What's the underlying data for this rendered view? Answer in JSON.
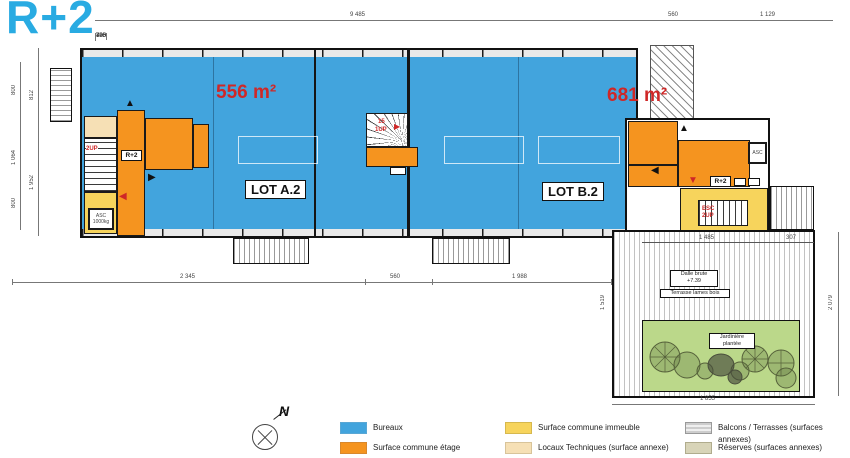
{
  "title": "R+2",
  "colors": {
    "title": "#29abe2",
    "bureaux": "#42a4dd",
    "commune-etage": "#f5941f",
    "commune-immeuble": "#f7d45c",
    "locaux": "#f6e0b5",
    "reserves": "#d8d4b8",
    "garden": "#bbd88a",
    "red": "#cf2727"
  },
  "areas": {
    "lot_a_area": "556 m²",
    "lot_b_area": "681 m²",
    "lot_a": "LOT A.2",
    "lot_b": "LOT B.2"
  },
  "cores": {
    "left_label": "R+2",
    "right_label": "R+2",
    "stair_left": "2UP",
    "stair_mid_count": "15",
    "stair_mid": "1UP",
    "stair_right_1": "ESC",
    "stair_right_2": "2UP",
    "elev_left_1": "ASC",
    "elev_left_2": "1000kg",
    "elev_right": "ASC"
  },
  "terrace": {
    "dalle_1": "Dalle brute",
    "dalle_2": "+7.39",
    "lames": "Terrasse lames bois",
    "jard_1": "Jardinière",
    "jard_2": "plantée"
  },
  "compass": {
    "label": "N"
  },
  "legend": {
    "items": [
      {
        "label": "Bureaux",
        "type": "blue"
      },
      {
        "label": "Surface commune étage",
        "type": "orange"
      },
      {
        "label": "Surface commune immeuble",
        "type": "yellow"
      },
      {
        "label": "Locaux Techniques (surface annexe)",
        "type": "tan"
      },
      {
        "label": "Balcons / Terrasses (surfaces annexes)",
        "type": "balc"
      },
      {
        "label": "Réserves (surfaces annexes)",
        "type": "res"
      }
    ]
  },
  "dims": {
    "top_total": "9 485",
    "top_right_a": "560",
    "top_right_b": "1 129",
    "top_segments": [
      "335",
      "700",
      "700",
      "700",
      "700",
      "700",
      "700",
      "700",
      "790",
      "700",
      "428"
    ],
    "left_outer": [
      "800",
      "1 064",
      "800"
    ],
    "left_inner": [
      "812",
      "1 952"
    ],
    "bottom": [
      "2 345",
      "560",
      "1 988"
    ],
    "terrace_bottom": "1 855",
    "terrace_left": "1 519",
    "terrace_right": "2 079",
    "terrace_top": [
      "1 485",
      "307"
    ]
  }
}
